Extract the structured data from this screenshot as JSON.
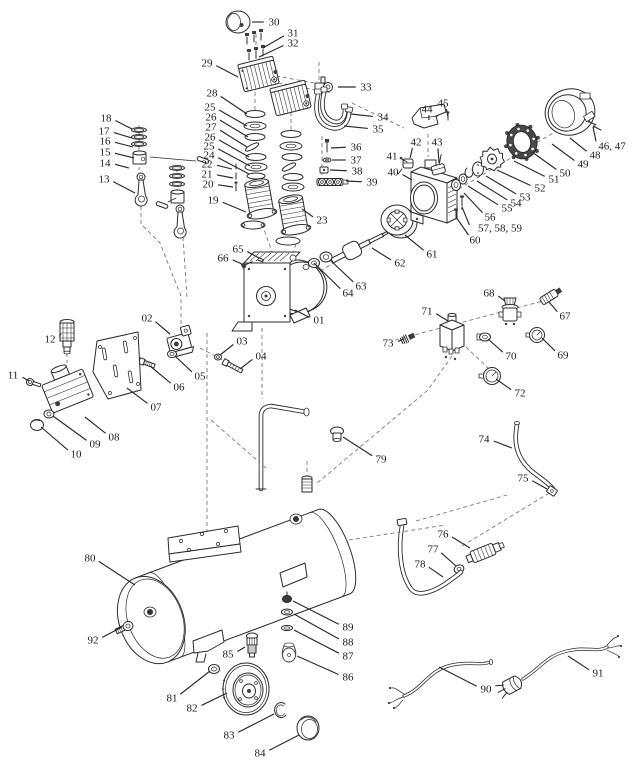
{
  "page": {
    "background": "#ffffff",
    "ink": "#2b2b2b",
    "frame": "#d8d8d8"
  },
  "diagram": {
    "type": "exploded-parts-diagram",
    "width": 640,
    "height": 768,
    "callouts": [
      {
        "n": "01",
        "x": 319,
        "y": 320,
        "tx": 295,
        "ty": 310
      },
      {
        "n": "02",
        "x": 147,
        "y": 318,
        "tx": 170,
        "ty": 334
      },
      {
        "n": "03",
        "x": 242,
        "y": 341,
        "tx": 220,
        "ty": 355
      },
      {
        "n": "04",
        "x": 261,
        "y": 356,
        "tx": 240,
        "ty": 369
      },
      {
        "n": "05",
        "x": 200,
        "y": 376,
        "tx": 176,
        "ty": 357
      },
      {
        "n": "06",
        "x": 179,
        "y": 387,
        "tx": 150,
        "ty": 366
      },
      {
        "n": "07",
        "x": 156,
        "y": 407,
        "tx": 127,
        "ty": 388
      },
      {
        "n": "08",
        "x": 114,
        "y": 437,
        "tx": 85,
        "ty": 417
      },
      {
        "n": "09",
        "x": 95,
        "y": 444,
        "tx": 53,
        "ty": 416
      },
      {
        "n": "10",
        "x": 76,
        "y": 454,
        "tx": 41,
        "ty": 427
      },
      {
        "n": "11",
        "x": 13,
        "y": 375,
        "tx": 29,
        "ty": 381
      },
      {
        "n": "12",
        "x": 50,
        "y": 339,
        "tx": 61,
        "ty": 334
      },
      {
        "n": "13",
        "x": 104,
        "y": 179,
        "tx": 135,
        "ty": 193
      },
      {
        "n": "14",
        "x": 105,
        "y": 163,
        "tx": 129,
        "ty": 168
      },
      {
        "n": "15",
        "x": 105,
        "y": 152,
        "tx": 134,
        "ty": 158
      },
      {
        "n": "16",
        "x": 105,
        "y": 141,
        "tx": 133,
        "ty": 147
      },
      {
        "n": "17",
        "x": 104,
        "y": 131,
        "tx": 132,
        "ty": 138
      },
      {
        "n": "18",
        "x": 106,
        "y": 118,
        "tx": 132,
        "ty": 129
      },
      {
        "n": "19",
        "x": 213,
        "y": 200,
        "tx": 246,
        "ty": 212
      },
      {
        "n": "20",
        "x": 208,
        "y": 184,
        "tx": 233,
        "ty": 187
      },
      {
        "n": "21",
        "x": 207,
        "y": 174,
        "tx": 233,
        "ty": 178
      },
      {
        "n": "22",
        "x": 207,
        "y": 164,
        "tx": 232,
        "ty": 169
      },
      {
        "n": "23",
        "x": 322,
        "y": 220,
        "tx": 302,
        "ty": 209
      },
      {
        "n": "24",
        "x": 209,
        "y": 155,
        "tx": 249,
        "ty": 174
      },
      {
        "n": "25",
        "x": 210,
        "y": 107,
        "tx": 247,
        "ty": 126
      },
      {
        "n": "26",
        "x": 211,
        "y": 117,
        "tx": 248,
        "ty": 137
      },
      {
        "n": "27",
        "x": 211,
        "y": 127,
        "tx": 247,
        "ty": 147
      },
      {
        "n": "26",
        "x": 210,
        "y": 137,
        "tx": 249,
        "ty": 157
      },
      {
        "n": "25",
        "x": 209,
        "y": 146,
        "tx": 250,
        "ty": 166
      },
      {
        "n": "28",
        "x": 212,
        "y": 93,
        "tx": 247,
        "ty": 114
      },
      {
        "n": "29",
        "x": 207,
        "y": 63,
        "tx": 238,
        "ty": 77
      },
      {
        "n": "30",
        "x": 274,
        "y": 22,
        "tx": 252,
        "ty": 22
      },
      {
        "n": "31",
        "x": 293,
        "y": 33,
        "tx": 263,
        "ty": 48
      },
      {
        "n": "32",
        "x": 293,
        "y": 43,
        "tx": 259,
        "ty": 57
      },
      {
        "n": "33",
        "x": 366,
        "y": 87,
        "tx": 338,
        "ty": 87
      },
      {
        "n": "34",
        "x": 383,
        "y": 117,
        "tx": 351,
        "ty": 114
      },
      {
        "n": "35",
        "x": 378,
        "y": 129,
        "tx": 344,
        "ty": 126
      },
      {
        "n": "36",
        "x": 356,
        "y": 147,
        "tx": 331,
        "ty": 148
      },
      {
        "n": "37",
        "x": 356,
        "y": 160,
        "tx": 332,
        "ty": 160
      },
      {
        "n": "38",
        "x": 357,
        "y": 171,
        "tx": 330,
        "ty": 170
      },
      {
        "n": "39",
        "x": 372,
        "y": 182,
        "tx": 346,
        "ty": 181
      },
      {
        "n": "40",
        "x": 393,
        "y": 172,
        "tx": 412,
        "ty": 180
      },
      {
        "n": "41",
        "x": 392,
        "y": 156,
        "tx": 404,
        "ty": 161
      },
      {
        "n": "42",
        "x": 416,
        "y": 142,
        "tx": 410,
        "ty": 158
      },
      {
        "n": "43",
        "x": 437,
        "y": 142,
        "tx": 439,
        "ty": 163
      },
      {
        "n": "44",
        "x": 427,
        "y": 109,
        "tx": 429,
        "ty": 120
      },
      {
        "n": "45",
        "x": 443,
        "y": 103,
        "tx": 448,
        "ty": 117
      },
      {
        "n": "46, 47",
        "x": 612,
        "y": 146,
        "tx": 593,
        "ty": 127
      },
      {
        "n": "48",
        "x": 595,
        "y": 155,
        "tx": 570,
        "ty": 138
      },
      {
        "n": "49",
        "x": 583,
        "y": 164,
        "tx": 552,
        "ty": 144
      },
      {
        "n": "50",
        "x": 565,
        "y": 173,
        "tx": 532,
        "ty": 152
      },
      {
        "n": "51",
        "x": 554,
        "y": 179,
        "tx": 514,
        "ty": 161
      },
      {
        "n": "52",
        "x": 540,
        "y": 188,
        "tx": 497,
        "ty": 170
      },
      {
        "n": "53",
        "x": 525,
        "y": 197,
        "tx": 486,
        "ty": 176
      },
      {
        "n": "54",
        "x": 516,
        "y": 203,
        "tx": 477,
        "ty": 181
      },
      {
        "n": "55",
        "x": 507,
        "y": 208,
        "tx": 468,
        "ty": 186
      },
      {
        "n": "56",
        "x": 490,
        "y": 217,
        "tx": 464,
        "ty": 193
      },
      {
        "n": "57, 58, 59",
        "x": 500,
        "y": 228,
        "tx": 462,
        "ty": 207
      },
      {
        "n": "60",
        "x": 475,
        "y": 240,
        "tx": 456,
        "ty": 217
      },
      {
        "n": "61",
        "x": 432,
        "y": 254,
        "tx": 405,
        "ty": 235
      },
      {
        "n": "62",
        "x": 400,
        "y": 263,
        "tx": 372,
        "ty": 248
      },
      {
        "n": "63",
        "x": 361,
        "y": 286,
        "tx": 330,
        "ty": 260
      },
      {
        "n": "64",
        "x": 348,
        "y": 293,
        "tx": 314,
        "ty": 263
      },
      {
        "n": "65",
        "x": 238,
        "y": 249,
        "tx": 259,
        "ty": 258
      },
      {
        "n": "66",
        "x": 223,
        "y": 258,
        "tx": 242,
        "ty": 264
      },
      {
        "n": "67",
        "x": 565,
        "y": 316,
        "tx": 549,
        "ty": 302
      },
      {
        "n": "68",
        "x": 489,
        "y": 293,
        "tx": 505,
        "ty": 301
      },
      {
        "n": "69",
        "x": 563,
        "y": 355,
        "tx": 542,
        "ty": 338
      },
      {
        "n": "70",
        "x": 511,
        "y": 356,
        "tx": 488,
        "ty": 339
      },
      {
        "n": "71",
        "x": 427,
        "y": 311,
        "tx": 448,
        "ty": 321
      },
      {
        "n": "72",
        "x": 520,
        "y": 393,
        "tx": 496,
        "ty": 379
      },
      {
        "n": "73",
        "x": 388,
        "y": 343,
        "tx": 404,
        "ty": 339
      },
      {
        "n": "74",
        "x": 484,
        "y": 439,
        "tx": 512,
        "ty": 448
      },
      {
        "n": "75",
        "x": 523,
        "y": 478,
        "tx": 547,
        "ty": 489
      },
      {
        "n": "76",
        "x": 443,
        "y": 534,
        "tx": 470,
        "ty": 548
      },
      {
        "n": "77",
        "x": 433,
        "y": 549,
        "tx": 456,
        "ty": 566
      },
      {
        "n": "78",
        "x": 420,
        "y": 564,
        "tx": 443,
        "ty": 577
      },
      {
        "n": "79",
        "x": 381,
        "y": 459,
        "tx": 343,
        "ty": 437
      },
      {
        "n": "80",
        "x": 90,
        "y": 558,
        "tx": 135,
        "ty": 585
      },
      {
        "n": "81",
        "x": 172,
        "y": 698,
        "tx": 210,
        "ty": 671
      },
      {
        "n": "82",
        "x": 192,
        "y": 708,
        "tx": 227,
        "ty": 693
      },
      {
        "n": "83",
        "x": 229,
        "y": 735,
        "tx": 274,
        "ty": 714
      },
      {
        "n": "84",
        "x": 260,
        "y": 753,
        "tx": 299,
        "ty": 735
      },
      {
        "n": "85",
        "x": 228,
        "y": 654,
        "tx": 245,
        "ty": 647
      },
      {
        "n": "86",
        "x": 348,
        "y": 677,
        "tx": 297,
        "ty": 656
      },
      {
        "n": "87",
        "x": 348,
        "y": 656,
        "tx": 294,
        "ty": 630
      },
      {
        "n": "88",
        "x": 348,
        "y": 642,
        "tx": 294,
        "ty": 614
      },
      {
        "n": "89",
        "x": 348,
        "y": 627,
        "tx": 293,
        "ty": 601
      },
      {
        "n": "90",
        "x": 486,
        "y": 689,
        "tx": 439,
        "ty": 667
      },
      {
        "n": "91",
        "x": 598,
        "y": 673,
        "tx": 568,
        "ty": 656
      },
      {
        "n": "92",
        "x": 93,
        "y": 640,
        "tx": 122,
        "ty": 627
      }
    ]
  }
}
